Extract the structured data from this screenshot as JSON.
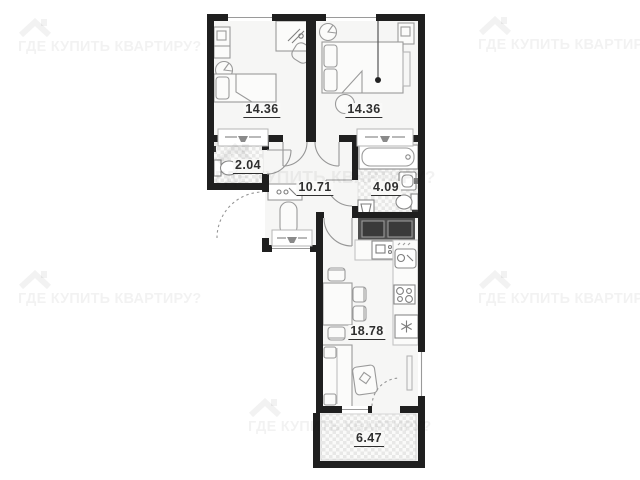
{
  "plan": {
    "rooms": [
      {
        "id": "bedroom-1",
        "area": "14.36"
      },
      {
        "id": "bedroom-2",
        "area": "14.36"
      },
      {
        "id": "wc",
        "area": "2.04"
      },
      {
        "id": "hallway",
        "area": "10.71"
      },
      {
        "id": "bathroom",
        "area": "4.09"
      },
      {
        "id": "kitchen-living",
        "area": "18.78"
      },
      {
        "id": "balcony",
        "area": "6.47"
      }
    ],
    "icons": [
      "house-roof-icon",
      "toilet-icon",
      "bathtub-icon",
      "sink-icon",
      "stove-icon",
      "fridge-snowflake-icon",
      "oven-icon",
      "laundry-basket-icon",
      "radiator-icon",
      "bed-icon",
      "sofa-icon",
      "dining-table-icon",
      "wardrobe-icon",
      "door-arc"
    ]
  },
  "watermark": {
    "text": "ГДЕ КУПИТЬ КВАРТИРУ?",
    "color": "#f2f2f2"
  },
  "colors": {
    "wall": "#1f1f1f",
    "room_fill": "#f6f6f5",
    "hatch": "#e8e8e7",
    "furniture_stroke": "#9a9a9a",
    "label": "#2f2f2f",
    "dark_cabinet": "#4f4f4f"
  }
}
